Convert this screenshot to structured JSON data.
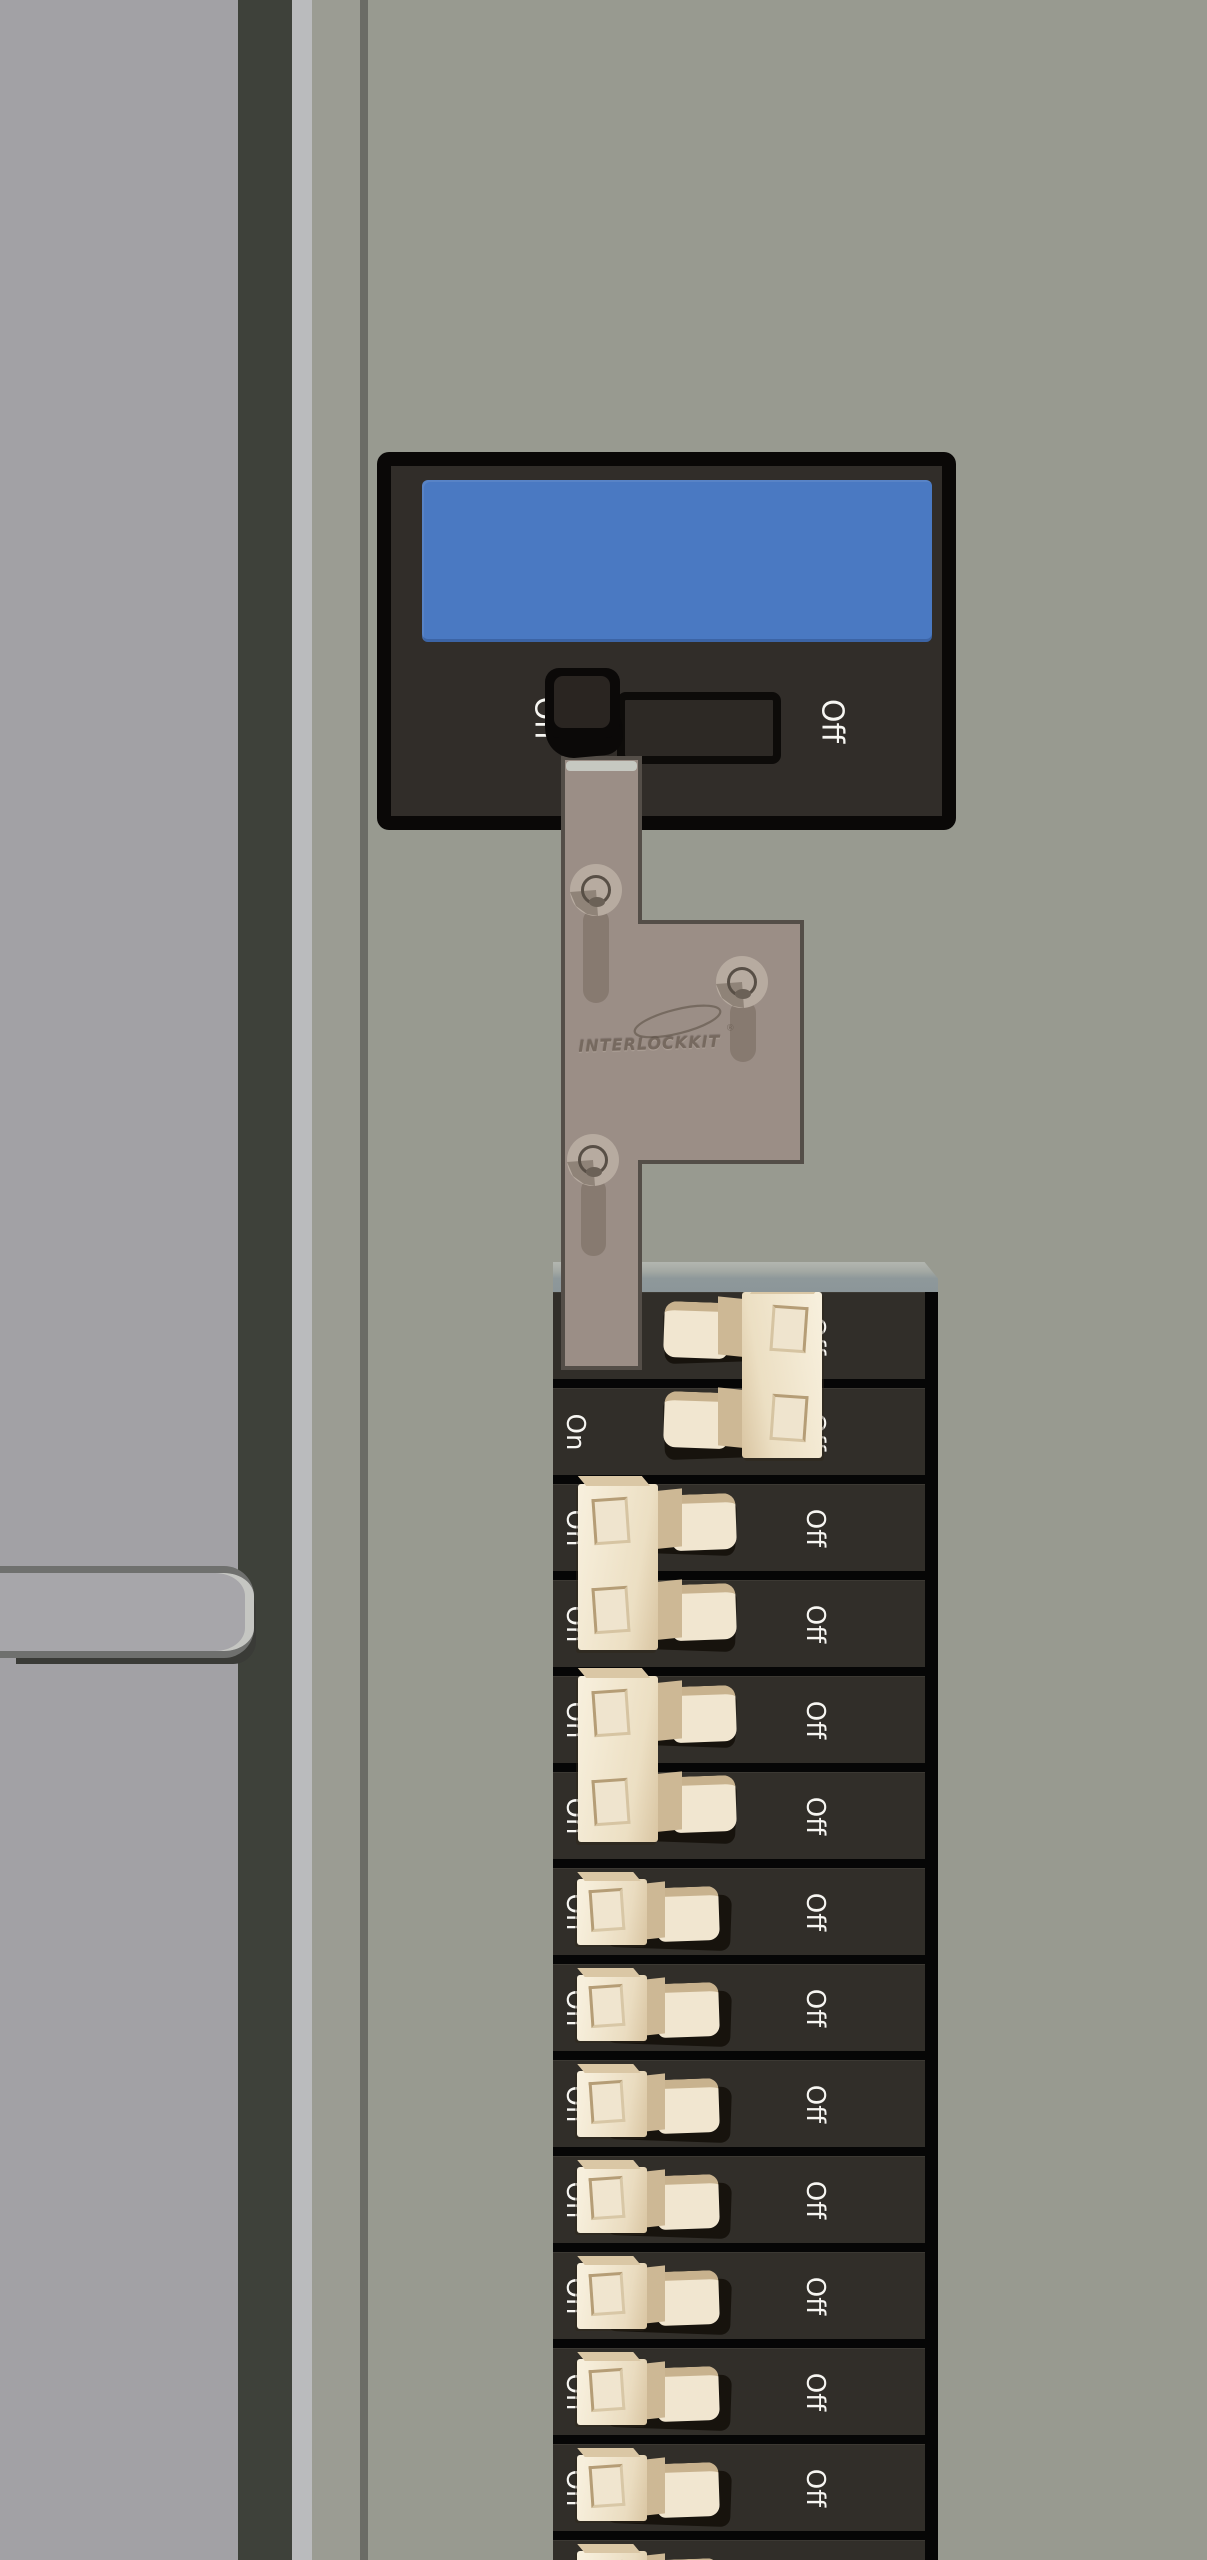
{
  "scene": {
    "description": "electrical-panel-with-generator-interlock",
    "wall_color": "#989a90",
    "door_color": "#a2a1a5"
  },
  "main_breaker": {
    "on_label": "On",
    "off_label": "Off",
    "position": "On",
    "label_color": "#4a79c2"
  },
  "interlock": {
    "brand": "INTERLOCKKIT",
    "registered_mark": "®",
    "plate_color": "#9b8e86"
  },
  "panel": {
    "row_count": 14,
    "on_label": "On",
    "off_label": "Off",
    "row_color": "#312e29",
    "breakers": [
      {
        "kind": "double",
        "rows": [
          1,
          2
        ],
        "position": "off"
      },
      {
        "kind": "double",
        "rows": [
          3,
          4
        ],
        "position": "on"
      },
      {
        "kind": "double",
        "rows": [
          5,
          6
        ],
        "position": "on"
      },
      {
        "kind": "single",
        "rows": [
          7
        ],
        "position": "on"
      },
      {
        "kind": "single",
        "rows": [
          8
        ],
        "position": "on"
      },
      {
        "kind": "single",
        "rows": [
          9
        ],
        "position": "on"
      },
      {
        "kind": "single",
        "rows": [
          10
        ],
        "position": "on"
      },
      {
        "kind": "single",
        "rows": [
          11
        ],
        "position": "on"
      },
      {
        "kind": "single",
        "rows": [
          12
        ],
        "position": "on"
      },
      {
        "kind": "single",
        "rows": [
          13
        ],
        "position": "on"
      },
      {
        "kind": "single",
        "rows": [
          14
        ],
        "position": "on"
      }
    ]
  }
}
